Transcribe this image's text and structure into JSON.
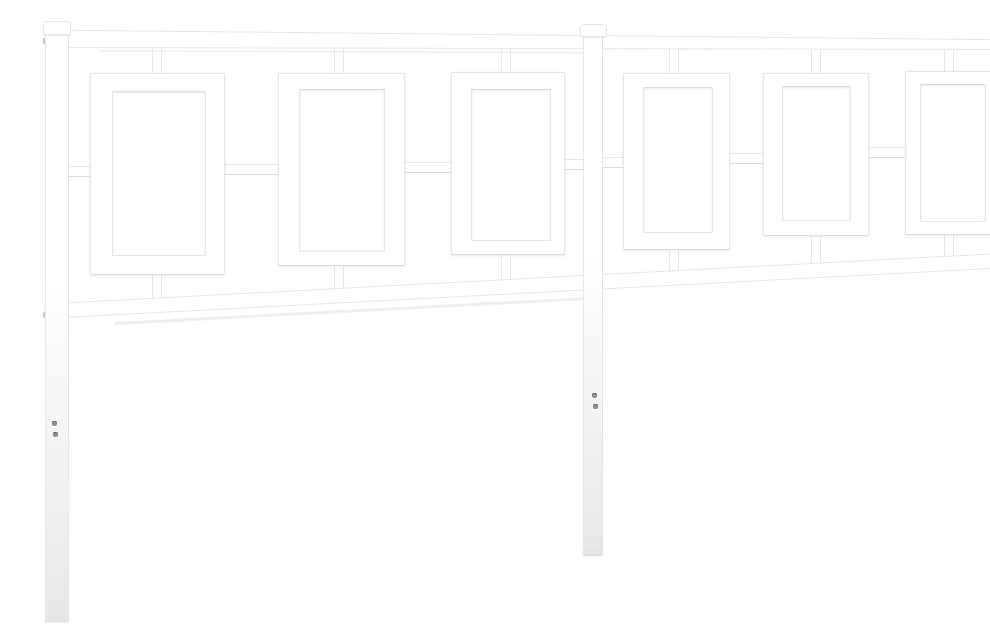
{
  "meta": {
    "subject": "White metal headboard",
    "description": "Product photo of a white steel bed headboard on a plain white background: left, center and right square posts with rounded caps, a straight top rail, a perspective-angled middle rail, and six rectangular frame openings (three per half) linked to the rails and posts by short connector tubes; small dark screw holes are visible on each post leg.",
    "view": "front, slight right-side perspective"
  },
  "colors": {
    "background": "#ffffff",
    "metal": "#ffffff",
    "outline": "#e4e7e9",
    "outline_dark": "#d9dcde",
    "shadow_line": "#edeff0",
    "leg_shade": "#ececec",
    "screw_hole": "#8f9296"
  },
  "counts": {
    "posts": 3,
    "rails": 2,
    "frame_openings": 6,
    "connector_tubes": 20,
    "screw_holes": 6
  }
}
